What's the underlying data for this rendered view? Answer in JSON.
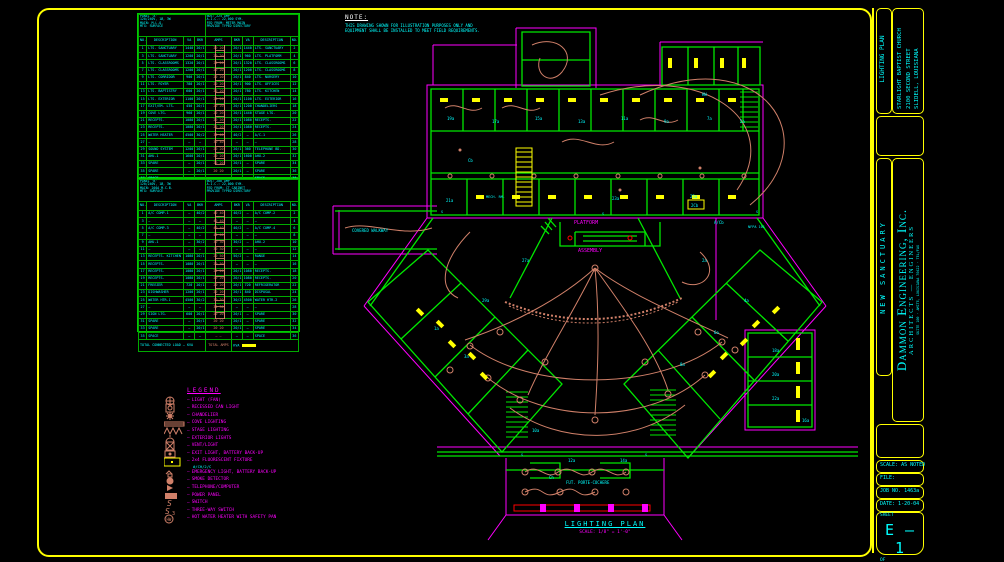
{
  "note": {
    "title": "NOTE:",
    "lines": [
      "THIS DRAWING SHOWN FOR ILLUSTRATION PURPOSES ONLY AND",
      "EQUIPMENT SHALL BE INSTALLED TO MEET FIELD REQUIREMENTS."
    ]
  },
  "plan_title": {
    "name": "LIGHTING PLAN",
    "scale": "SCALE: 1/8\" = 1'-0\""
  },
  "titleblock": {
    "sheet_title": "LIGHTING PLAN",
    "project": [
      "STARLIGHT BAPTIST CHURCH",
      "2100 SECOND STREET",
      "SLIDELL, LOUISIANA"
    ],
    "project_name": "NEW SANCTUARY",
    "firm_name": "Dammon Engineering, Inc.",
    "firm_sub": "ARCHITECTS — ENGINEERS",
    "firm_addr": "SUITE 100 · AMITE, LOUISIANA 70422 · TEL/FAX",
    "scale": "SCALE: AS NOTED",
    "file": "FILE:",
    "job": "JOB NO. 1463a",
    "date": "DATE: 1-20-04",
    "sheet_label": "SHEET",
    "sheet_no": "E — 1",
    "of_label": "OF"
  },
  "legend": {
    "title": "LEGEND",
    "items": [
      {
        "icon": "light-fan",
        "label": "LIGHT (FAN)"
      },
      {
        "icon": "recessed-can",
        "label": "RECESSED CAN LIGHT"
      },
      {
        "icon": "chandelier",
        "label": "CHANDELIER"
      },
      {
        "icon": "cove",
        "label": "COVE LIGHTING"
      },
      {
        "icon": "stage",
        "label": "STAGE LIGHTING"
      },
      {
        "icon": "exterior",
        "label": "EXTERIOR LIGHTS"
      },
      {
        "icon": "vent",
        "label": "VENT/LIGHT"
      },
      {
        "icon": "exit",
        "label": "EXIT LIGHT, BATTERY BACK-UP"
      },
      {
        "icon": "fluor",
        "label": "2x4 FLUORESCENT FIXTURE",
        "sub": "#/CH/2/C"
      },
      {
        "icon": "emerg",
        "label": "EMERGENCY LIGHT, BATTERY BACK-UP"
      },
      {
        "icon": "smoke",
        "label": "SMOKE DETECTOR"
      },
      {
        "icon": "tel",
        "label": "TELEPHONE/COMPUTER"
      },
      {
        "icon": "panel",
        "label": "POWER PANEL"
      },
      {
        "icon": "switch",
        "label": "SWITCH"
      },
      {
        "icon": "sw3",
        "label": "THREE-WAY SWITCH"
      },
      {
        "icon": "hw",
        "label": "HOT WATER HEATER WITH SAFETY PAN"
      }
    ]
  },
  "panel_schedules": [
    {
      "title_left": [
        "PANEL 'A'",
        "120/240V, 1Ø, 3W",
        "MAIN: M.L.O.",
        "MTG: SURFACE"
      ],
      "title_right": [
        "BUS: 225 AMP",
        "A.I.C.: 22,000 SYM.",
        "FED FROM: METER MAIN",
        "PROVIDE TYPED DIRECTORY"
      ],
      "columns": [
        "NO.",
        "DESCRIPTION",
        "VA",
        "BKR",
        "AMPS",
        "BKR",
        "VA",
        "DESCRIPTION",
        "NO."
      ],
      "rows": [
        [
          "1",
          "LTS. SANCTUARY",
          "1440",
          "20/1",
          "20 20",
          "20/1",
          "1440",
          "LTS. SANCTUARY",
          "2"
        ],
        [
          "3",
          "LTS. SANCTUARY",
          "1200",
          "20/1",
          "20 20",
          "20/1",
          "960",
          "LTS. PLATFORM",
          "4"
        ],
        [
          "5",
          "LTS. CLASSROOMS",
          "1320",
          "20/1",
          "20 20",
          "20/1",
          "1320",
          "LTS. CLASSROOMS",
          "6"
        ],
        [
          "7",
          "LTS. CLASSROOMS",
          "1200",
          "20/1",
          "20 20",
          "20/1",
          "1200",
          "LTS. CLASSROOMS",
          "8"
        ],
        [
          "9",
          "LTS. CORRIDOR",
          "900",
          "20/1",
          "20 20",
          "20/1",
          "840",
          "LTS. NURSERY",
          "10"
        ],
        [
          "11",
          "LTS. FOYER",
          "780",
          "20/1",
          "20 20",
          "20/1",
          "900",
          "LTS. OFFICES",
          "12"
        ],
        [
          "13",
          "LTS. BAPTISTRY",
          "600",
          "20/1",
          "20 20",
          "20/1",
          "780",
          "LTS. KITCHEN",
          "14"
        ],
        [
          "15",
          "LTS. EXTERIOR",
          "1100",
          "20/1",
          "20 20",
          "20/1",
          "1100",
          "LTS. EXTERIOR",
          "16"
        ],
        [
          "17",
          "EXIT/EM. LTS.",
          "450",
          "20/1",
          "20 20",
          "20/1",
          "1200",
          "CHANDELIERS",
          "18"
        ],
        [
          "19",
          "COVE LTG.",
          "960",
          "20/1",
          "20 20",
          "20/1",
          "1440",
          "STAGE LTG.",
          "20"
        ],
        [
          "21",
          "RECEPTS.",
          "1080",
          "20/1",
          "20 20",
          "20/1",
          "1080",
          "RECEPTS.",
          "22"
        ],
        [
          "23",
          "RECEPTS.",
          "1080",
          "20/1",
          "20 20",
          "20/1",
          "1080",
          "RECEPTS.",
          "24"
        ],
        [
          "25",
          "WATER HEATER",
          "4500",
          "30/2",
          "30 40",
          "40/2",
          "—",
          "A/C-1",
          "26"
        ],
        [
          "27",
          "—",
          "—",
          "—",
          "30 40",
          "—",
          "—",
          "—",
          "28"
        ],
        [
          "29",
          "SOUND SYSTEM",
          "1200",
          "20/1",
          "20 20",
          "20/1",
          "360",
          "TELEPHONE BD.",
          "30"
        ],
        [
          "31",
          "AHU-1",
          "1600",
          "20/1",
          "20 20",
          "20/1",
          "1600",
          "AHU-2",
          "32"
        ],
        [
          "33",
          "SPARE",
          "—",
          "20/1",
          "20 20",
          "20/1",
          "—",
          "SPARE",
          "34"
        ],
        [
          "35",
          "SPARE",
          "—",
          "20/1",
          "20 20",
          "20/1",
          "—",
          "SPARE",
          "36"
        ],
        [
          "37",
          "SPACE",
          "—",
          "—",
          "— —",
          "—",
          "—",
          "SPACE",
          "38"
        ]
      ],
      "footer": {
        "left": "TOTAL CONNECTED LOAD — KVA",
        "mid": "TOTAL AMPS",
        "right": "KVA"
      }
    },
    {
      "title_left": [
        "PANEL 'B'",
        "120/240V, 1Ø, 3W",
        "MAIN: 200A M.C.B.",
        "MTG: SURFACE"
      ],
      "title_right": [
        "BUS: 200 AMP",
        "A.I.C.: 22,000 SYM.",
        "FED FROM: CT CABINET",
        "PROVIDE TYPED DIRECTORY"
      ],
      "columns": [
        "NO.",
        "DESCRIPTION",
        "VA",
        "BKR",
        "AMPS",
        "BKR",
        "VA",
        "DESCRIPTION",
        "NO."
      ],
      "rows": [
        [
          "1",
          "A/C COMP-1",
          "—",
          "40/2",
          "40 40",
          "40/2",
          "—",
          "A/C COMP-2",
          "2"
        ],
        [
          "3",
          "—",
          "—",
          "—",
          "40 40",
          "—",
          "—",
          "—",
          "4"
        ],
        [
          "5",
          "A/C COMP-3",
          "—",
          "40/2",
          "40 40",
          "40/2",
          "—",
          "A/C COMP-4",
          "6"
        ],
        [
          "7",
          "—",
          "—",
          "—",
          "40 40",
          "—",
          "—",
          "—",
          "8"
        ],
        [
          "9",
          "AHU-1",
          "—",
          "30/2",
          "30 30",
          "30/2",
          "—",
          "AHU-2",
          "10"
        ],
        [
          "11",
          "—",
          "—",
          "—",
          "30 30",
          "—",
          "—",
          "—",
          "12"
        ],
        [
          "13",
          "RECEPTS. KITCHEN",
          "1080",
          "20/1",
          "20 50",
          "50/2",
          "—",
          "RANGE",
          "14"
        ],
        [
          "15",
          "RECEPTS.",
          "1080",
          "20/1",
          "20 50",
          "—",
          "—",
          "—",
          "16"
        ],
        [
          "17",
          "RECEPTS.",
          "1080",
          "20/1",
          "20 20",
          "20/1",
          "1080",
          "RECEPTS.",
          "18"
        ],
        [
          "19",
          "RECEPTS.",
          "1080",
          "20/1",
          "20 20",
          "20/1",
          "1080",
          "RECEPTS.",
          "20"
        ],
        [
          "21",
          "FREEZER",
          "720",
          "20/1",
          "20 20",
          "20/1",
          "720",
          "REFRIGERATOR",
          "22"
        ],
        [
          "23",
          "DISHWASHER",
          "1200",
          "20/1",
          "20 20",
          "20/1",
          "840",
          "DISPOSAL",
          "24"
        ],
        [
          "25",
          "WATER HTR-1",
          "4500",
          "30/2",
          "30 30",
          "30/2",
          "4500",
          "WATER HTR-2",
          "26"
        ],
        [
          "27",
          "—",
          "—",
          "—",
          "30 30",
          "—",
          "—",
          "—",
          "28"
        ],
        [
          "29",
          "SIGN LTG.",
          "600",
          "20/1",
          "20 20",
          "20/1",
          "—",
          "SPARE",
          "30"
        ],
        [
          "31",
          "SPARE",
          "—",
          "20/1",
          "20 20",
          "20/1",
          "—",
          "SPARE",
          "32"
        ],
        [
          "33",
          "SPARE",
          "—",
          "20/1",
          "20 20",
          "20/1",
          "—",
          "SPARE",
          "34"
        ],
        [
          "35",
          "SPACE",
          "—",
          "—",
          "— —",
          "—",
          "—",
          "SPACE",
          "36"
        ]
      ],
      "footer": {
        "left": "TOTAL CONNECTED LOAD — KVA",
        "mid": "TOTAL AMPS",
        "right": "KVA"
      }
    }
  ],
  "plan": {
    "labels": [
      {
        "t": "PLATFORM",
        "x": 574,
        "y": 224,
        "c": "#ff00ff",
        "s": 5
      },
      {
        "t": "ASSEMBLY",
        "x": 578,
        "y": 252,
        "c": "#ff00ff",
        "s": 5
      },
      {
        "t": "COVERED WALKWAY",
        "x": 352,
        "y": 232,
        "c": "#00ffff",
        "s": 4
      },
      {
        "t": "FUT. PORTE-COCHERE",
        "x": 566,
        "y": 484,
        "c": "#00ffff",
        "s": 4
      },
      {
        "t": "MECH. RM.",
        "x": 486,
        "y": 198,
        "c": "#00ffff",
        "s": 3.5
      },
      {
        "t": "NFPA 101",
        "x": 748,
        "y": 228,
        "c": "#00ffff",
        "s": 3.5
      },
      {
        "t": "19a",
        "x": 447,
        "y": 120,
        "c": "#00ffff",
        "s": 4
      },
      {
        "t": "17a",
        "x": 492,
        "y": 123,
        "c": "#00ffff",
        "s": 4
      },
      {
        "t": "15a",
        "x": 535,
        "y": 120,
        "c": "#00ffff",
        "s": 4
      },
      {
        "t": "13a",
        "x": 578,
        "y": 123,
        "c": "#00ffff",
        "s": 4
      },
      {
        "t": "11a",
        "x": 621,
        "y": 120,
        "c": "#00ffff",
        "s": 4
      },
      {
        "t": "9a",
        "x": 664,
        "y": 123,
        "c": "#00ffff",
        "s": 4
      },
      {
        "t": "7a",
        "x": 707,
        "y": 120,
        "c": "#00ffff",
        "s": 4
      },
      {
        "t": "5a",
        "x": 740,
        "y": 123,
        "c": "#00ffff",
        "s": 4
      },
      {
        "t": "Cb",
        "x": 468,
        "y": 162,
        "c": "#00ffff",
        "s": 4
      },
      {
        "t": "21a",
        "x": 446,
        "y": 202,
        "c": "#00ffff",
        "s": 4
      },
      {
        "t": "23a",
        "x": 612,
        "y": 200,
        "c": "#00ffff",
        "s": 4
      },
      {
        "t": "25a",
        "x": 690,
        "y": 198,
        "c": "#00ffff",
        "s": 4
      },
      {
        "t": "27a",
        "x": 522,
        "y": 262,
        "c": "#00ffff",
        "s": 4
      },
      {
        "t": "29a",
        "x": 482,
        "y": 302,
        "c": "#00ffff",
        "s": 4
      },
      {
        "t": "1a",
        "x": 434,
        "y": 330,
        "c": "#00ffff",
        "s": 4
      },
      {
        "t": "3a",
        "x": 464,
        "y": 358,
        "c": "#00ffff",
        "s": 4
      },
      {
        "t": "2a",
        "x": 702,
        "y": 262,
        "c": "#00ffff",
        "s": 4
      },
      {
        "t": "4a",
        "x": 744,
        "y": 302,
        "c": "#00ffff",
        "s": 4
      },
      {
        "t": "6a",
        "x": 714,
        "y": 334,
        "c": "#00ffff",
        "s": 4
      },
      {
        "t": "8a",
        "x": 680,
        "y": 366,
        "c": "#00ffff",
        "s": 4
      },
      {
        "t": "10a",
        "x": 532,
        "y": 432,
        "c": "#00ffff",
        "s": 4
      },
      {
        "t": "12a",
        "x": 568,
        "y": 462,
        "c": "#00ffff",
        "s": 4
      },
      {
        "t": "14a",
        "x": 620,
        "y": 462,
        "c": "#00ffff",
        "s": 4
      },
      {
        "t": "16a",
        "x": 802,
        "y": 422,
        "c": "#00ffff",
        "s": 4
      },
      {
        "t": "18a",
        "x": 772,
        "y": 352,
        "c": "#00ffff",
        "s": 4
      },
      {
        "t": "20a",
        "x": 772,
        "y": 376,
        "c": "#00ffff",
        "s": 4
      },
      {
        "t": "22a",
        "x": 772,
        "y": 400,
        "c": "#00ffff",
        "s": 4
      },
      {
        "t": "Ch",
        "x": 549,
        "y": 479,
        "c": "#00ffff",
        "s": 4
      },
      {
        "t": "A/Cb",
        "x": 714,
        "y": 224,
        "c": "#00ffff",
        "s": 4
      },
      {
        "t": "HW",
        "x": 702,
        "y": 96,
        "c": "#00ffff",
        "s": 4
      },
      {
        "t": "2Cb",
        "x": 691,
        "y": 207,
        "c": "#00ffff",
        "s": 4
      },
      {
        "t": "S",
        "x": 441,
        "y": 213,
        "c": "#00ffff",
        "s": 3.5
      },
      {
        "t": "S",
        "x": 602,
        "y": 215,
        "c": "#00ffff",
        "s": 3.5
      },
      {
        "t": "S",
        "x": 756,
        "y": 213,
        "c": "#00ffff",
        "s": 3.5
      },
      {
        "t": "S",
        "x": 521,
        "y": 456,
        "c": "#00ffff",
        "s": 3.5
      },
      {
        "t": "S",
        "x": 645,
        "y": 456,
        "c": "#00ffff",
        "s": 3.5
      }
    ]
  }
}
